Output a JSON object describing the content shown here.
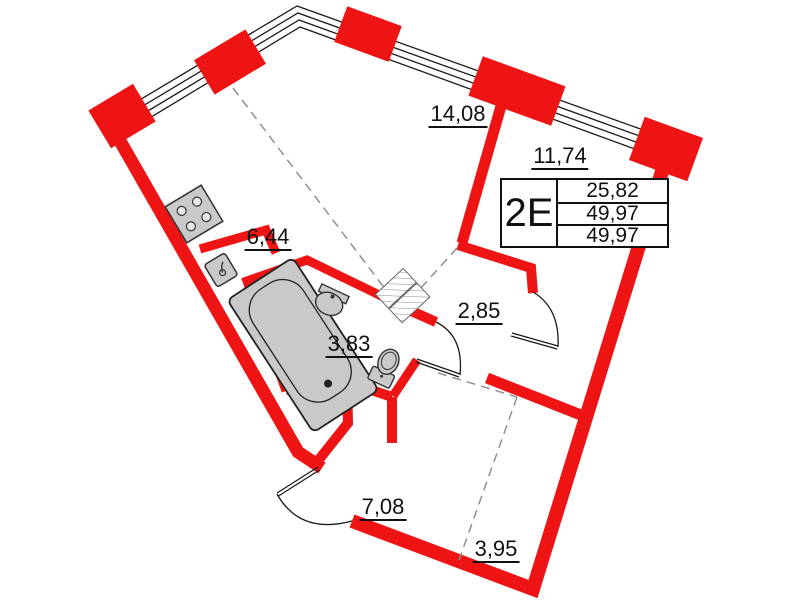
{
  "floorplan": {
    "unit": {
      "type_label": "2Е",
      "areas": [
        "25,82",
        "49,97",
        "49,97"
      ]
    },
    "room_areas": [
      "14,08",
      "11,74",
      "6,44",
      "2,85",
      "3,83",
      "7,08",
      "3,95"
    ],
    "colors": {
      "wall_red": "#ee1414",
      "fixture_gray": "#c9c9c9",
      "dash_gray": "#8f8f8f",
      "line_black": "#1a1a1a"
    },
    "fixtures": [
      "stove",
      "kitchen-sink",
      "bathtub",
      "washbasin",
      "toilet",
      "wardrobe"
    ]
  }
}
